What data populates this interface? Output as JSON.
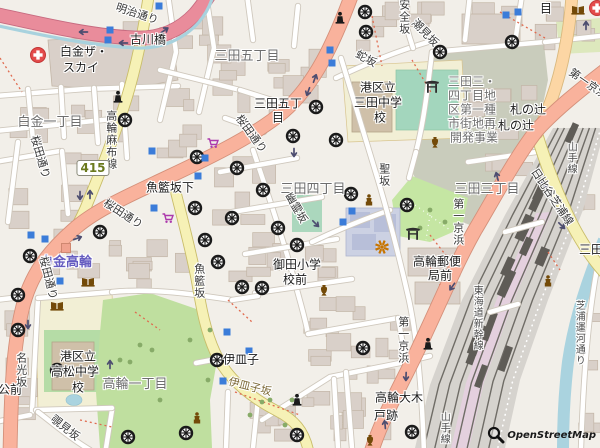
{
  "attribution": {
    "text": "OpenStreetMap"
  },
  "route_shield": {
    "number": "415",
    "x": 93,
    "y": 168
  },
  "colors": {
    "background": "#f2efe9",
    "trunk_road": "#f9b29c",
    "motorway_pink": "#e98c9b",
    "primary_road": "#fcd6a4",
    "secondary_road": "#f6f1b6",
    "water": "#aad3df",
    "park_green": "#c5e6a3",
    "estate_green": "#bfdf9f",
    "building": "#d9d0c9",
    "subway_entrance_blue": "#3b7cd9",
    "station_label": "#655cc0",
    "temple_icon": "#1a1a1a",
    "poi_brown": "#734a08",
    "supermarket_purple": "#ac39ac",
    "hospital_red": "#e34b4b",
    "viewpoint_orange": "#c77400"
  },
  "labels": [
    {
      "text": "白金一丁目",
      "x": 50,
      "y": 123,
      "cls": "place"
    },
    {
      "text": "三田五丁目",
      "x": 247,
      "y": 57,
      "cls": "place"
    },
    {
      "text": "三田四丁目",
      "x": 313,
      "y": 190,
      "cls": "place"
    },
    {
      "text": "三田三丁目",
      "x": 487,
      "y": 190,
      "cls": "place"
    },
    {
      "text": "高輪一丁目",
      "x": 135,
      "y": 385,
      "cls": "place"
    },
    {
      "text": "古川橋",
      "x": 148,
      "y": 40,
      "cls": "name"
    },
    {
      "text": "白金ザ・",
      "x": 84,
      "y": 52,
      "cls": "name"
    },
    {
      "text": "スカイ",
      "x": 81,
      "y": 68,
      "cls": "name"
    },
    {
      "text": "三田五丁",
      "x": 278,
      "y": 104,
      "cls": "name"
    },
    {
      "text": "目",
      "x": 278,
      "y": 118,
      "cls": "name"
    },
    {
      "text": "魚籃坂下",
      "x": 170,
      "y": 188,
      "cls": "name"
    },
    {
      "text": "港区立",
      "x": 378,
      "y": 88,
      "cls": "name"
    },
    {
      "text": "三田中学",
      "x": 378,
      "y": 103,
      "cls": "name"
    },
    {
      "text": "校",
      "x": 380,
      "y": 118,
      "cls": "name"
    },
    {
      "text": "札の辻",
      "x": 528,
      "y": 110,
      "cls": "name"
    },
    {
      "text": "札の辻",
      "x": 516,
      "y": 126,
      "cls": "name"
    },
    {
      "text": "目",
      "x": 546,
      "y": 9,
      "cls": "name"
    },
    {
      "text": "御田小学",
      "x": 297,
      "y": 265,
      "cls": "name"
    },
    {
      "text": "校前",
      "x": 295,
      "y": 280,
      "cls": "name"
    },
    {
      "text": "高輪郵便",
      "x": 437,
      "y": 262,
      "cls": "name"
    },
    {
      "text": "局前",
      "x": 440,
      "y": 276,
      "cls": "name"
    },
    {
      "text": "港区立",
      "x": 78,
      "y": 357,
      "cls": "name"
    },
    {
      "text": "高松中学",
      "x": 75,
      "y": 372,
      "cls": "name"
    },
    {
      "text": "校",
      "x": 78,
      "y": 388,
      "cls": "name"
    },
    {
      "text": "伊皿子",
      "x": 241,
      "y": 360,
      "cls": "name"
    },
    {
      "text": "高輪大木",
      "x": 399,
      "y": 398,
      "cls": "name"
    },
    {
      "text": "戸跡",
      "x": 386,
      "y": 416,
      "cls": "name"
    },
    {
      "text": "三田",
      "x": 591,
      "y": 250,
      "cls": "name"
    },
    {
      "text": "公前",
      "x": 10,
      "y": 390,
      "cls": "name"
    },
    {
      "text": "三田三・",
      "x": 472,
      "y": 82,
      "cls": "area"
    },
    {
      "text": "四丁目地",
      "x": 472,
      "y": 96,
      "cls": "area"
    },
    {
      "text": "区第一種",
      "x": 472,
      "y": 110,
      "cls": "area"
    },
    {
      "text": "市街地再",
      "x": 472,
      "y": 124,
      "cls": "area"
    },
    {
      "text": "開発事業",
      "x": 474,
      "y": 138,
      "cls": "area"
    },
    {
      "text": "白金高輪",
      "x": 66,
      "y": 263,
      "cls": "station"
    },
    {
      "text": "明治通り",
      "x": 137,
      "y": 14,
      "cls": "road",
      "rot": 18
    },
    {
      "text": "桜田通り",
      "x": 251,
      "y": 134,
      "cls": "road",
      "rot": 54
    },
    {
      "text": "桜田通り",
      "x": 123,
      "y": 214,
      "cls": "road",
      "rot": 33
    },
    {
      "text": "桜田通り",
      "x": 40,
      "y": 157,
      "cls": "road",
      "rot": 74
    },
    {
      "text": "桜田通り",
      "x": 48,
      "y": 278,
      "cls": "road",
      "rot": 76
    },
    {
      "text": "第一京浜",
      "x": 588,
      "y": 84,
      "cls": "road",
      "rot": 35
    },
    {
      "text": "第一京浜",
      "x": 458,
      "y": 222,
      "cls": "road",
      "v": true
    },
    {
      "text": "第一京浜",
      "x": 403,
      "y": 340,
      "cls": "road",
      "v": true
    },
    {
      "text": "日比谷芝浦線",
      "x": 552,
      "y": 197,
      "cls": "road",
      "rot": 56
    },
    {
      "text": "高輪麻布線",
      "x": 111,
      "y": 140,
      "cls": "road",
      "v": true
    },
    {
      "text": "聖坂",
      "x": 384,
      "y": 175,
      "cls": "road",
      "v": true
    },
    {
      "text": "魚籃坂",
      "x": 199,
      "y": 281,
      "cls": "road",
      "v": true
    },
    {
      "text": "安全坂",
      "x": 404,
      "y": 17,
      "cls": "road",
      "v": true
    },
    {
      "text": "潮見坂",
      "x": 425,
      "y": 33,
      "cls": "road",
      "rot": 46
    },
    {
      "text": "蛇坂",
      "x": 366,
      "y": 59,
      "cls": "road",
      "rot": 28
    },
    {
      "text": "幽霊坂",
      "x": 296,
      "y": 208,
      "cls": "road",
      "rot": 60
    },
    {
      "text": "名光坂",
      "x": 21,
      "y": 370,
      "cls": "road",
      "v": true
    },
    {
      "text": "伊皿子坂",
      "x": 250,
      "y": 387,
      "cls": "slope",
      "rot": 14
    },
    {
      "text": "覗見坂",
      "x": 65,
      "y": 428,
      "cls": "road",
      "rot": 38
    },
    {
      "text": "芝浦運河通り",
      "x": 578,
      "y": 333,
      "cls": "rail",
      "v": true
    },
    {
      "text": "山手線",
      "x": 570,
      "y": 158,
      "cls": "rail",
      "v": true
    },
    {
      "text": "山手線",
      "x": 443,
      "y": 428,
      "cls": "rail",
      "v": true
    },
    {
      "text": "東海道新幹線",
      "x": 476,
      "y": 318,
      "cls": "rail",
      "v": true
    }
  ],
  "icons": {
    "temples": [
      [
        365,
        12
      ],
      [
        366,
        32
      ],
      [
        440,
        52
      ],
      [
        512,
        42
      ],
      [
        316,
        107
      ],
      [
        293,
        136
      ],
      [
        336,
        140
      ],
      [
        125,
        120
      ],
      [
        197,
        157
      ],
      [
        237,
        168
      ],
      [
        263,
        190
      ],
      [
        195,
        208
      ],
      [
        232,
        218
      ],
      [
        100,
        232
      ],
      [
        205,
        240
      ],
      [
        218,
        262
      ],
      [
        278,
        228
      ],
      [
        297,
        245
      ],
      [
        242,
        287
      ],
      [
        262,
        288
      ],
      [
        30,
        256
      ],
      [
        18,
        295
      ],
      [
        18,
        330
      ],
      [
        57,
        370
      ],
      [
        128,
        437
      ],
      [
        186,
        433
      ],
      [
        217,
        360
      ],
      [
        363,
        348
      ],
      [
        297,
        435
      ],
      [
        412,
        432
      ],
      [
        351,
        194
      ],
      [
        407,
        205
      ]
    ],
    "subway_entrances": [
      [
        159,
        6
      ],
      [
        110,
        30
      ],
      [
        108,
        40
      ],
      [
        330,
        50
      ],
      [
        332,
        63
      ],
      [
        506,
        15
      ],
      [
        518,
        12
      ],
      [
        352,
        211
      ],
      [
        343,
        222
      ],
      [
        152,
        151
      ],
      [
        205,
        158
      ],
      [
        198,
        176
      ],
      [
        154,
        208
      ],
      [
        31,
        235
      ],
      [
        45,
        239
      ],
      [
        60,
        281
      ],
      [
        227,
        332
      ],
      [
        249,
        351
      ],
      [
        223,
        381
      ]
    ],
    "station_squares": [
      [
        66,
        248
      ]
    ],
    "torii": [
      [
        432,
        87
      ],
      [
        413,
        234
      ]
    ],
    "hospitals": [
      [
        38,
        55
      ],
      [
        597,
        8
      ]
    ],
    "libraries": [
      [
        578,
        10
      ],
      [
        88,
        282
      ],
      [
        57,
        306
      ]
    ],
    "supermarkets": [
      [
        213,
        143
      ],
      [
        168,
        218
      ]
    ],
    "memorials": [
      [
        340,
        18
      ],
      [
        118,
        97
      ],
      [
        297,
        400
      ],
      [
        428,
        344
      ]
    ],
    "statues": [
      [
        369,
        200
      ],
      [
        548,
        281
      ],
      [
        197,
        418
      ]
    ],
    "artworks": [
      [
        435,
        142
      ],
      [
        324,
        290
      ],
      [
        370,
        440
      ]
    ],
    "viewpoints": [
      [
        382,
        247
      ]
    ],
    "oneway_arrows": [
      [
        315,
        78,
        20
      ],
      [
        308,
        92,
        200
      ],
      [
        83,
        32,
        270
      ],
      [
        123,
        43,
        270
      ],
      [
        165,
        30,
        55
      ],
      [
        80,
        196,
        180
      ],
      [
        90,
        194,
        0
      ],
      [
        78,
        238,
        70
      ],
      [
        586,
        25,
        0
      ],
      [
        497,
        176,
        345
      ],
      [
        452,
        287,
        215
      ],
      [
        406,
        377,
        182
      ],
      [
        385,
        424,
        -5
      ],
      [
        545,
        186,
        135
      ],
      [
        562,
        226,
        135
      ],
      [
        294,
        153,
        180
      ],
      [
        316,
        224,
        135
      ],
      [
        28,
        325,
        180
      ],
      [
        110,
        364,
        0
      ]
    ]
  }
}
